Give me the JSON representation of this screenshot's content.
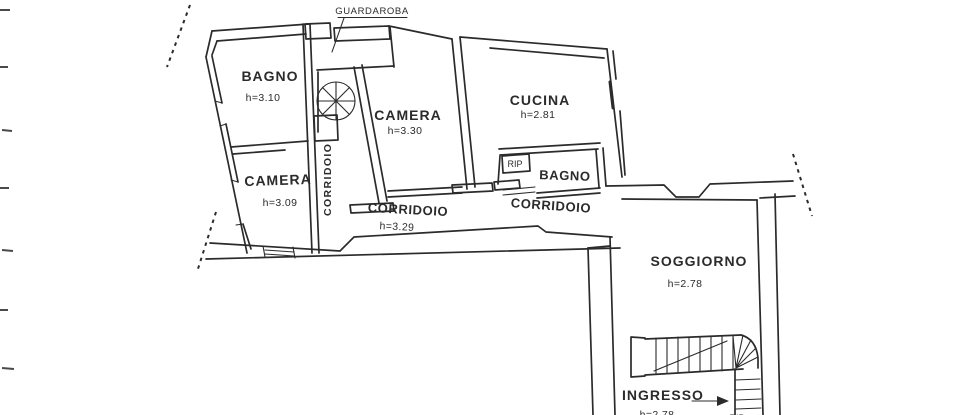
{
  "document": {
    "kind": "scanned floor plan"
  },
  "colors": {
    "ink": "#2b2b2b",
    "paper": "#ffffff"
  },
  "labels": {
    "guardaroba": "GUARDAROBA",
    "bagno_nw": {
      "name": "BAGNO",
      "h": "h=3.10"
    },
    "camera_w": {
      "name": "CAMERA",
      "h": "h=3.09"
    },
    "camera_c": {
      "name": "CAMERA",
      "h": "h=3.30"
    },
    "cucina": {
      "name": "CUCINA",
      "h": "h=2.81"
    },
    "corridoio_stair": "CORRIDOIO",
    "corridoio_main": {
      "name": "CORRIDOIO",
      "h": "h=3.29"
    },
    "corridoio_e": "CORRIDOIO",
    "rip": "RIP",
    "bagno_c": "BAGNO",
    "soggiorno": {
      "name": "SOGGIORNO",
      "h": "h=2.78"
    },
    "ingresso": {
      "name": "INGRESSO",
      "h": "h=2.78"
    },
    "rip_under_stairs": "RIP"
  }
}
